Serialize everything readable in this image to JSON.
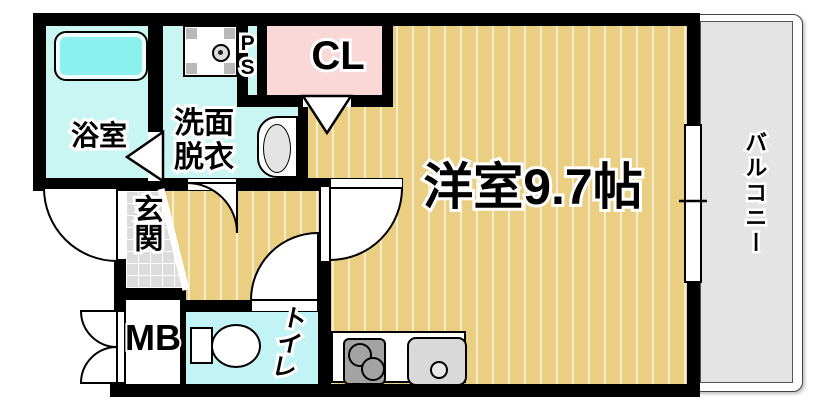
{
  "title": "floor-plan",
  "rooms": {
    "bathroom": {
      "label": "浴室"
    },
    "washroom": {
      "label": "洗面\n脱衣"
    },
    "pipe_space": {
      "label": "PS"
    },
    "closet": {
      "label": "CL"
    },
    "main_room": {
      "label": "洋室9.7帖",
      "size_tatami": "9.7帖"
    },
    "balcony": {
      "label": "バルコニー"
    },
    "entrance": {
      "label": "玄関"
    },
    "meter_box": {
      "label": "MB"
    },
    "toilet": {
      "label": "トイレ"
    }
  },
  "fixtures": [
    "bathtub",
    "washing-machine-pan",
    "wash-basin",
    "toilet-fixture",
    "stove-two-burner",
    "kitchen-sink",
    "sliding-window",
    "hinged-doors",
    "folding-doors"
  ],
  "colors": {
    "wall": "#000000",
    "wet-floor": "#c9f6f3",
    "bathtub": "#8af1ee",
    "closet-pink": "#fad8d8",
    "room-tan": "#eace81",
    "balcony-gray": "#e4e4e4",
    "entrance-tile": "#dcdcdc",
    "stove-gray": "#a3a3a3"
  }
}
